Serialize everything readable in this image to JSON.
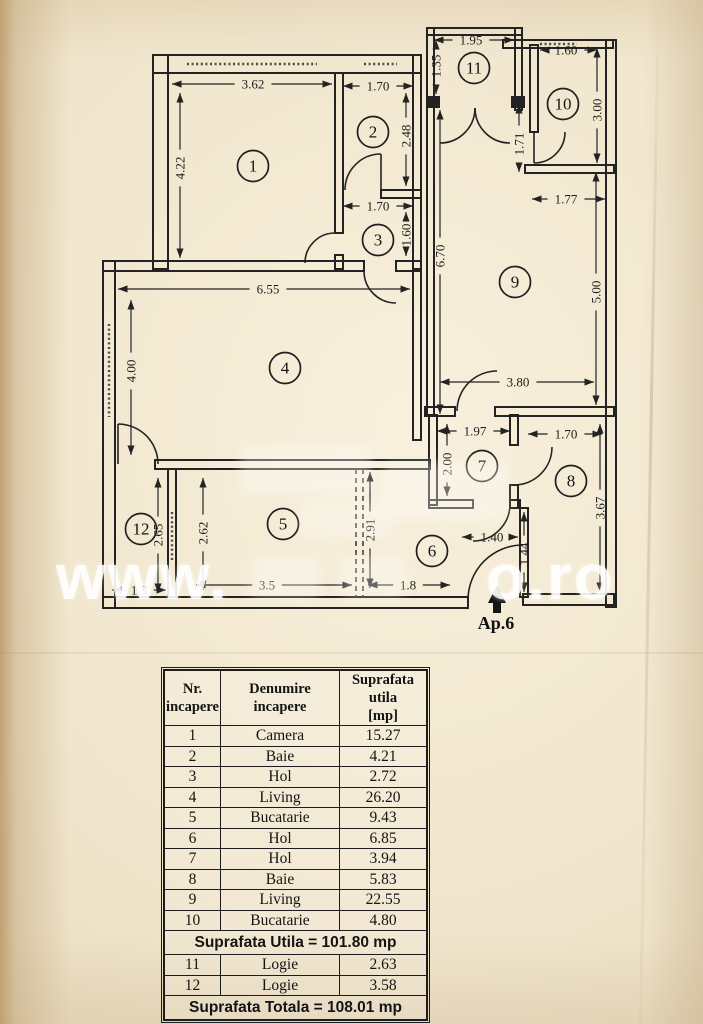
{
  "watermark": {
    "left": "www.",
    "right": "o.ro"
  },
  "plan": {
    "entrance_label": "Ap.6",
    "rooms": [
      {
        "n": "1",
        "x": 253,
        "y": 166
      },
      {
        "n": "2",
        "x": 373,
        "y": 132
      },
      {
        "n": "3",
        "x": 378,
        "y": 240
      },
      {
        "n": "4",
        "x": 285,
        "y": 368
      },
      {
        "n": "5",
        "x": 283,
        "y": 524
      },
      {
        "n": "6",
        "x": 432,
        "y": 551
      },
      {
        "n": "7",
        "x": 482,
        "y": 466
      },
      {
        "n": "8",
        "x": 571,
        "y": 481
      },
      {
        "n": "9",
        "x": 515,
        "y": 282
      },
      {
        "n": "10",
        "x": 563,
        "y": 104
      },
      {
        "n": "11",
        "x": 474,
        "y": 68
      },
      {
        "n": "12",
        "x": 141,
        "y": 529
      }
    ],
    "dims": [
      {
        "t": "3.62",
        "o": "h",
        "at": 84,
        "c": 253,
        "from": 172,
        "to": 332
      },
      {
        "t": "1.70",
        "o": "h",
        "at": 86,
        "c": 378,
        "from": 343,
        "to": 413
      },
      {
        "t": "4.22",
        "o": "v",
        "at": 180,
        "c": 168,
        "from": 93,
        "to": 258
      },
      {
        "t": "2.48",
        "o": "v",
        "at": 406,
        "c": 136,
        "from": 93,
        "to": 186
      },
      {
        "t": "1.70",
        "o": "h",
        "at": 206,
        "c": 378,
        "from": 343,
        "to": 413
      },
      {
        "t": "1.60",
        "o": "v",
        "at": 406,
        "c": 235,
        "from": 212,
        "to": 256
      },
      {
        "t": "6.55",
        "o": "h",
        "at": 289,
        "c": 268,
        "from": 118,
        "to": 410
      },
      {
        "t": "4.00",
        "o": "v",
        "at": 131,
        "c": 371,
        "from": 300,
        "to": 455
      },
      {
        "t": "2.65",
        "o": "v",
        "at": 158,
        "c": 535,
        "from": 478,
        "to": 593
      },
      {
        "t": "2.62",
        "o": "v",
        "at": 203,
        "c": 533,
        "from": 478,
        "to": 590
      },
      {
        "t": "2.91",
        "o": "v",
        "at": 370,
        "c": 530,
        "from": 472,
        "to": 588
      },
      {
        "t": "1.3",
        "o": "h",
        "at": 590,
        "c": 139,
        "from": 112,
        "to": 166
      },
      {
        "t": "3.5",
        "o": "h",
        "at": 585,
        "c": 267,
        "from": 196,
        "to": 352
      },
      {
        "t": "1.8",
        "o": "h",
        "at": 585,
        "c": 408,
        "from": 368,
        "to": 450
      },
      {
        "t": "1.95",
        "o": "h",
        "at": 40,
        "c": 471,
        "from": 434,
        "to": 514
      },
      {
        "t": "1.35",
        "o": "v",
        "at": 436,
        "c": 66,
        "from": 40,
        "to": 94
      },
      {
        "t": "1.60",
        "o": "h",
        "at": 50,
        "c": 566,
        "from": 540,
        "to": 597
      },
      {
        "t": "3.00",
        "o": "v",
        "at": 597,
        "c": 110,
        "from": 48,
        "to": 163
      },
      {
        "t": "1.71",
        "o": "v",
        "at": 519,
        "c": 144,
        "from": 104,
        "to": 172
      },
      {
        "t": "1.77",
        "o": "h",
        "at": 199,
        "c": 566,
        "from": 532,
        "to": 605
      },
      {
        "t": "6.70",
        "o": "v",
        "at": 440,
        "c": 256,
        "from": 110,
        "to": 414
      },
      {
        "t": "5.00",
        "o": "v",
        "at": 596,
        "c": 292,
        "from": 172,
        "to": 405
      },
      {
        "t": "3.80",
        "o": "h",
        "at": 382,
        "c": 518,
        "from": 440,
        "to": 594
      },
      {
        "t": "1.97",
        "o": "h",
        "at": 431,
        "c": 475,
        "from": 437,
        "to": 510
      },
      {
        "t": "2.00",
        "o": "v",
        "at": 447,
        "c": 464,
        "from": 424,
        "to": 496
      },
      {
        "t": "1.70",
        "o": "h",
        "at": 434,
        "c": 566,
        "from": 528,
        "to": 602
      },
      {
        "t": "3.67",
        "o": "v",
        "at": 600,
        "c": 508,
        "from": 424,
        "to": 592
      },
      {
        "t": "1.40",
        "o": "h",
        "at": 537,
        "c": 492,
        "from": 462,
        "to": 518
      },
      {
        "t": "1.44",
        "o": "v",
        "at": 524,
        "c": 554,
        "from": 512,
        "to": 592
      }
    ]
  },
  "table": {
    "headers": [
      "Nr.\nincapere",
      "Denumire\nincapere",
      "Suprafata utila\n[mp]"
    ],
    "rows": [
      [
        "1",
        "Camera",
        "15.27"
      ],
      [
        "2",
        "Baie",
        "4.21"
      ],
      [
        "3",
        "Hol",
        "2.72"
      ],
      [
        "4",
        "Living",
        "26.20"
      ],
      [
        "5",
        "Bucatarie",
        "9.43"
      ],
      [
        "6",
        "Hol",
        "6.85"
      ],
      [
        "7",
        "Hol",
        "3.94"
      ],
      [
        "8",
        "Baie",
        "5.83"
      ],
      [
        "9",
        "Living",
        "22.55"
      ],
      [
        "10",
        "Bucatarie",
        "4.80"
      ]
    ],
    "subtotal": "Suprafata Utila  =  101.80 mp",
    "rows2": [
      [
        "11",
        "Logie",
        "2.63"
      ],
      [
        "12",
        "Logie",
        "3.58"
      ]
    ],
    "total": "Suprafata Totala  =  108.01 mp"
  }
}
